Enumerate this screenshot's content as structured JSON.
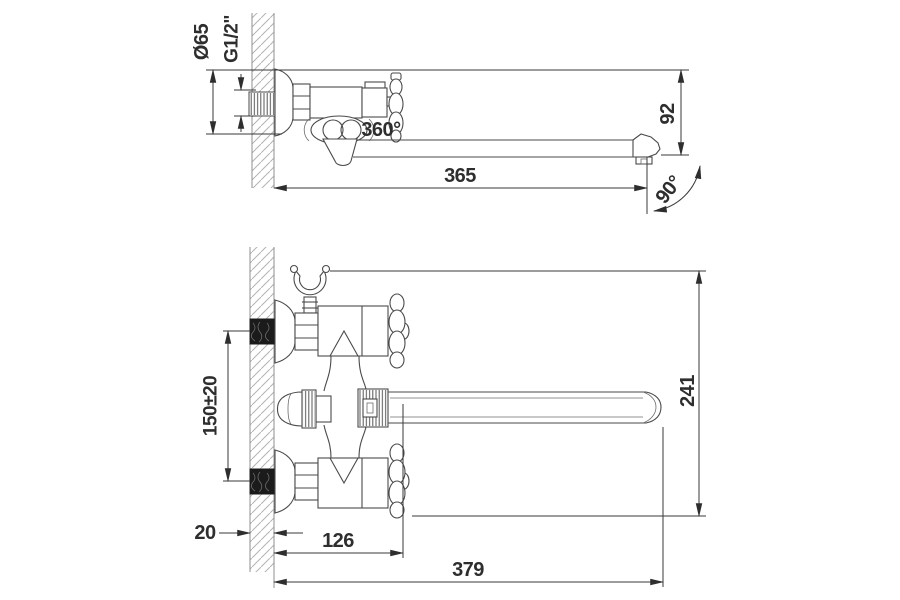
{
  "drawing_type": "faucet-installation-dimension-drawing",
  "colors": {
    "background": "#ffffff",
    "part_line": "#4a4a4a",
    "dimension_line": "#3a3a3a",
    "wall_hatch": "#b3b3b3",
    "dark_fitting": "#1b1b1b"
  },
  "side_view": {
    "labels": {
      "flange_diameter": "Ø65",
      "thread_size": "G1/2\"",
      "spout_swivel": "360°",
      "spout_length": "365",
      "spout_height": "92",
      "swing_angle": "90°"
    }
  },
  "front_view": {
    "labels": {
      "inlet_centers": "150±20",
      "overall_height": "241",
      "wall_offset": "20",
      "body_width": "126",
      "overall_width": "379"
    }
  }
}
